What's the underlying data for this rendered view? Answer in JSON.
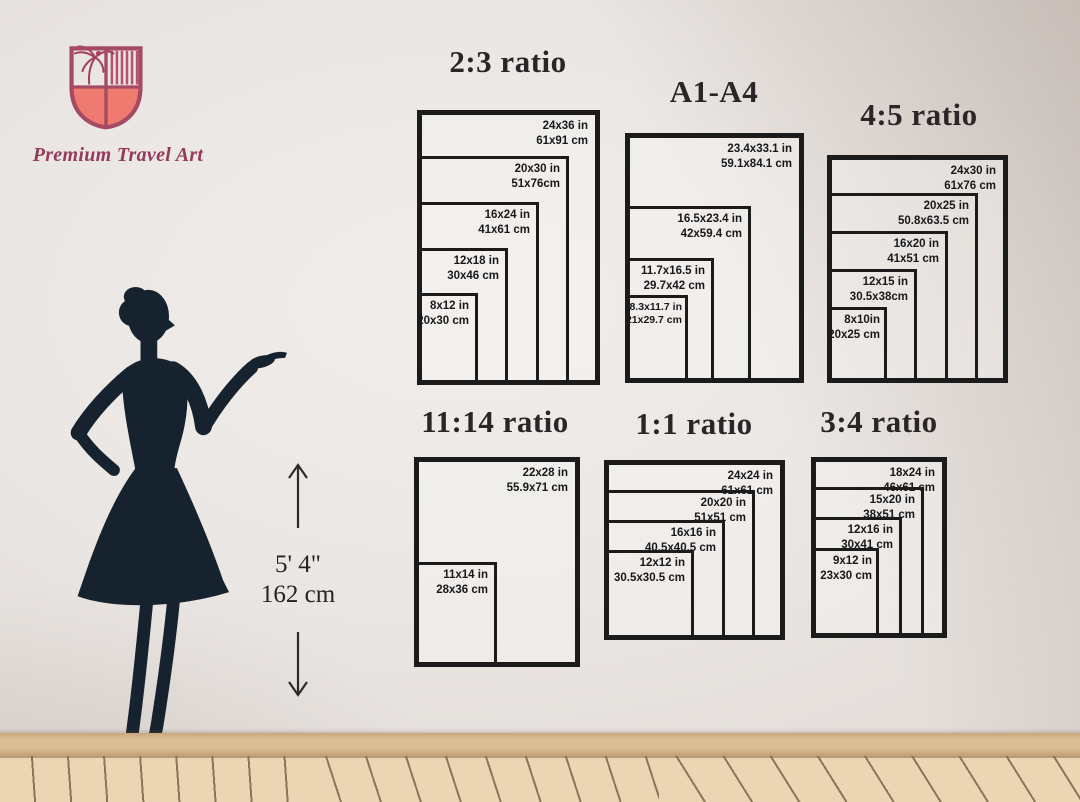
{
  "brand": {
    "name": "Premium Travel Art"
  },
  "height_indicator": {
    "feet": "5' 4\"",
    "cm": "162 cm"
  },
  "charts": [
    {
      "title": "2:3 ratio",
      "sizes": [
        {
          "in": "24x36 in",
          "cm": "61x91 cm"
        },
        {
          "in": "20x30 in",
          "cm": "51x76cm"
        },
        {
          "in": "16x24 in",
          "cm": "41x61 cm"
        },
        {
          "in": "12x18 in",
          "cm": "30x46 cm"
        },
        {
          "in": "8x12 in",
          "cm": "20x30 cm"
        }
      ]
    },
    {
      "title": "A1-A4",
      "sizes": [
        {
          "in": "23.4x33.1 in",
          "cm": "59.1x84.1 cm"
        },
        {
          "in": "16.5x23.4 in",
          "cm": "42x59.4 cm"
        },
        {
          "in": "11.7x16.5 in",
          "cm": "29.7x42 cm"
        },
        {
          "in": "8.3x11.7 in",
          "cm": "21x29.7 cm"
        }
      ]
    },
    {
      "title": "4:5 ratio",
      "sizes": [
        {
          "in": "24x30 in",
          "cm": "61x76 cm"
        },
        {
          "in": "20x25 in",
          "cm": "50.8x63.5 cm"
        },
        {
          "in": "16x20 in",
          "cm": "41x51 cm"
        },
        {
          "in": "12x15 in",
          "cm": "30.5x38cm"
        },
        {
          "in": "8x10in",
          "cm": "20x25 cm"
        }
      ]
    },
    {
      "title": "11:14 ratio",
      "sizes": [
        {
          "in": "22x28 in",
          "cm": "55.9x71 cm"
        },
        {
          "in": "11x14 in",
          "cm": "28x36 cm"
        }
      ]
    },
    {
      "title": "1:1 ratio",
      "sizes": [
        {
          "in": "24x24 in",
          "cm": "61x61 cm"
        },
        {
          "in": "20x20 in",
          "cm": "51x51 cm"
        },
        {
          "in": "16x16 in",
          "cm": "40.5x40.5 cm"
        },
        {
          "in": "12x12 in",
          "cm": "30.5x30.5 cm"
        }
      ]
    },
    {
      "title": "3:4 ratio",
      "sizes": [
        {
          "in": "18x24 in",
          "cm": "46x61 cm"
        },
        {
          "in": "15x20 in",
          "cm": "38x51 cm"
        },
        {
          "in": "12x16 in",
          "cm": "30x41 cm"
        },
        {
          "in": "9x12 in",
          "cm": "23x30 cm"
        }
      ]
    }
  ],
  "colors": {
    "line": "#1b1b1c",
    "wall": "#eae6e3",
    "silhouette": "#16222e",
    "shield_coral": "#ef7a70",
    "shield_outline": "#a54a63",
    "brand_text": "#97395a",
    "baseboard": "#d8ba8e",
    "floor": "#ead6b3"
  }
}
